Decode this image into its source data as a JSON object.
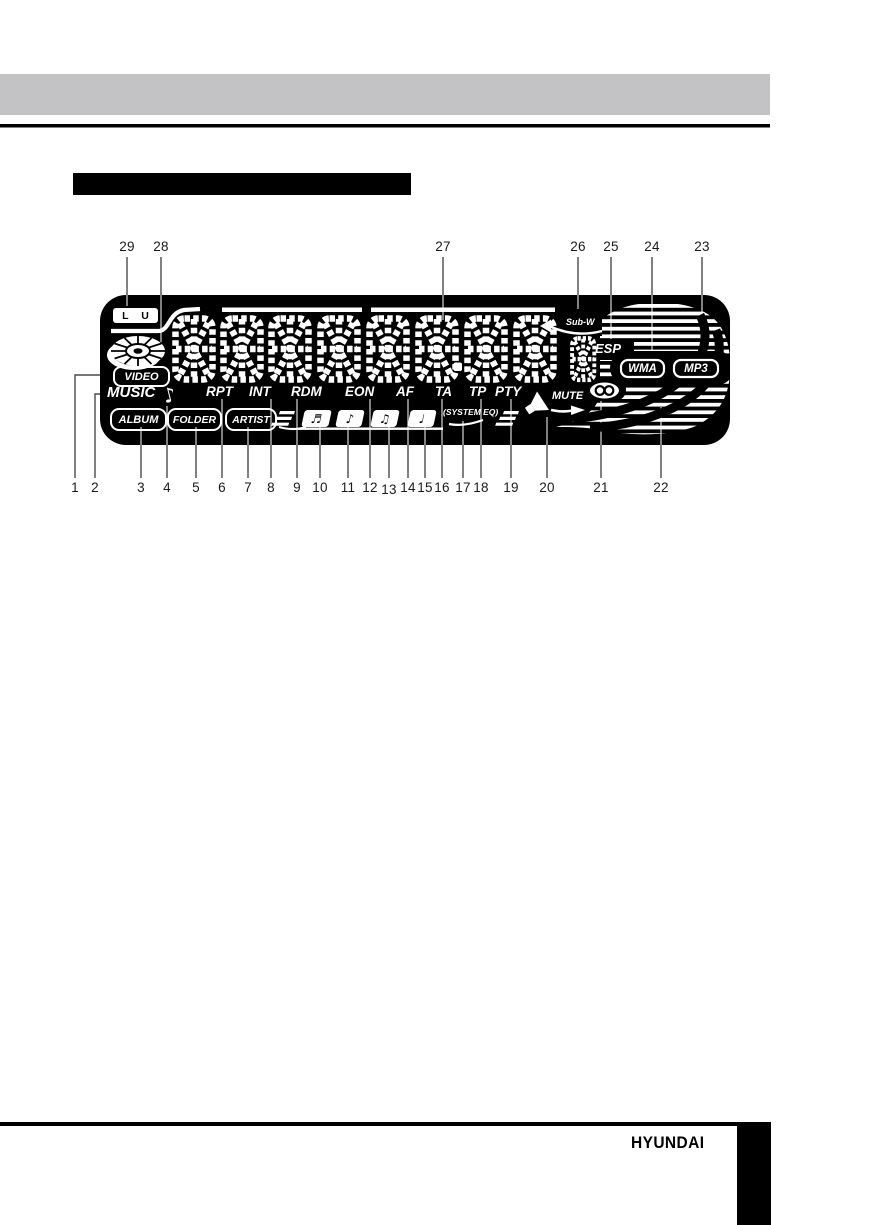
{
  "display": {
    "indicators": {
      "lu": "L U",
      "video": "VIDEO",
      "music": "MUSIC",
      "album": "ALBUM",
      "folder": "FOLDER",
      "artist": "ARTIST",
      "rpt": "RPT",
      "int": "INT",
      "rdm": "RDM",
      "eon": "EON",
      "af": "AF",
      "ta": "TA",
      "tp": "TP",
      "pty": "PTY",
      "system_eq": "(SYSTEM EQ)",
      "esp": "ESP",
      "sub_w": "Sub-W",
      "mute": "MUTE",
      "wma": "WMA",
      "mp3": "MP3"
    },
    "icons": {
      "disc": "disc-icon",
      "note": "♪",
      "chip_notes": [
        "♬",
        "♪",
        "♫",
        "♩"
      ],
      "stereo": "stereo-icon",
      "mute_speaker": "mute-speaker-icon",
      "sub_w_arrow": "left-arrow-icon",
      "eq_bars": "eq-bars-icon"
    },
    "colors": {
      "display_bg": "#000000",
      "segments": "#ffffff",
      "header_bar": "#c3c3c6"
    }
  },
  "callouts": {
    "top": [
      "29",
      "28",
      "27",
      "26",
      "25",
      "24",
      "23"
    ],
    "bottom": [
      "1",
      "2",
      "3",
      "4",
      "5",
      "6",
      "7",
      "8",
      "9",
      "10",
      "11",
      "12",
      "13",
      "14",
      "15",
      "16",
      "17",
      "18",
      "19",
      "20",
      "21",
      "22"
    ]
  },
  "footer": {
    "brand": "HYUNDAI"
  }
}
